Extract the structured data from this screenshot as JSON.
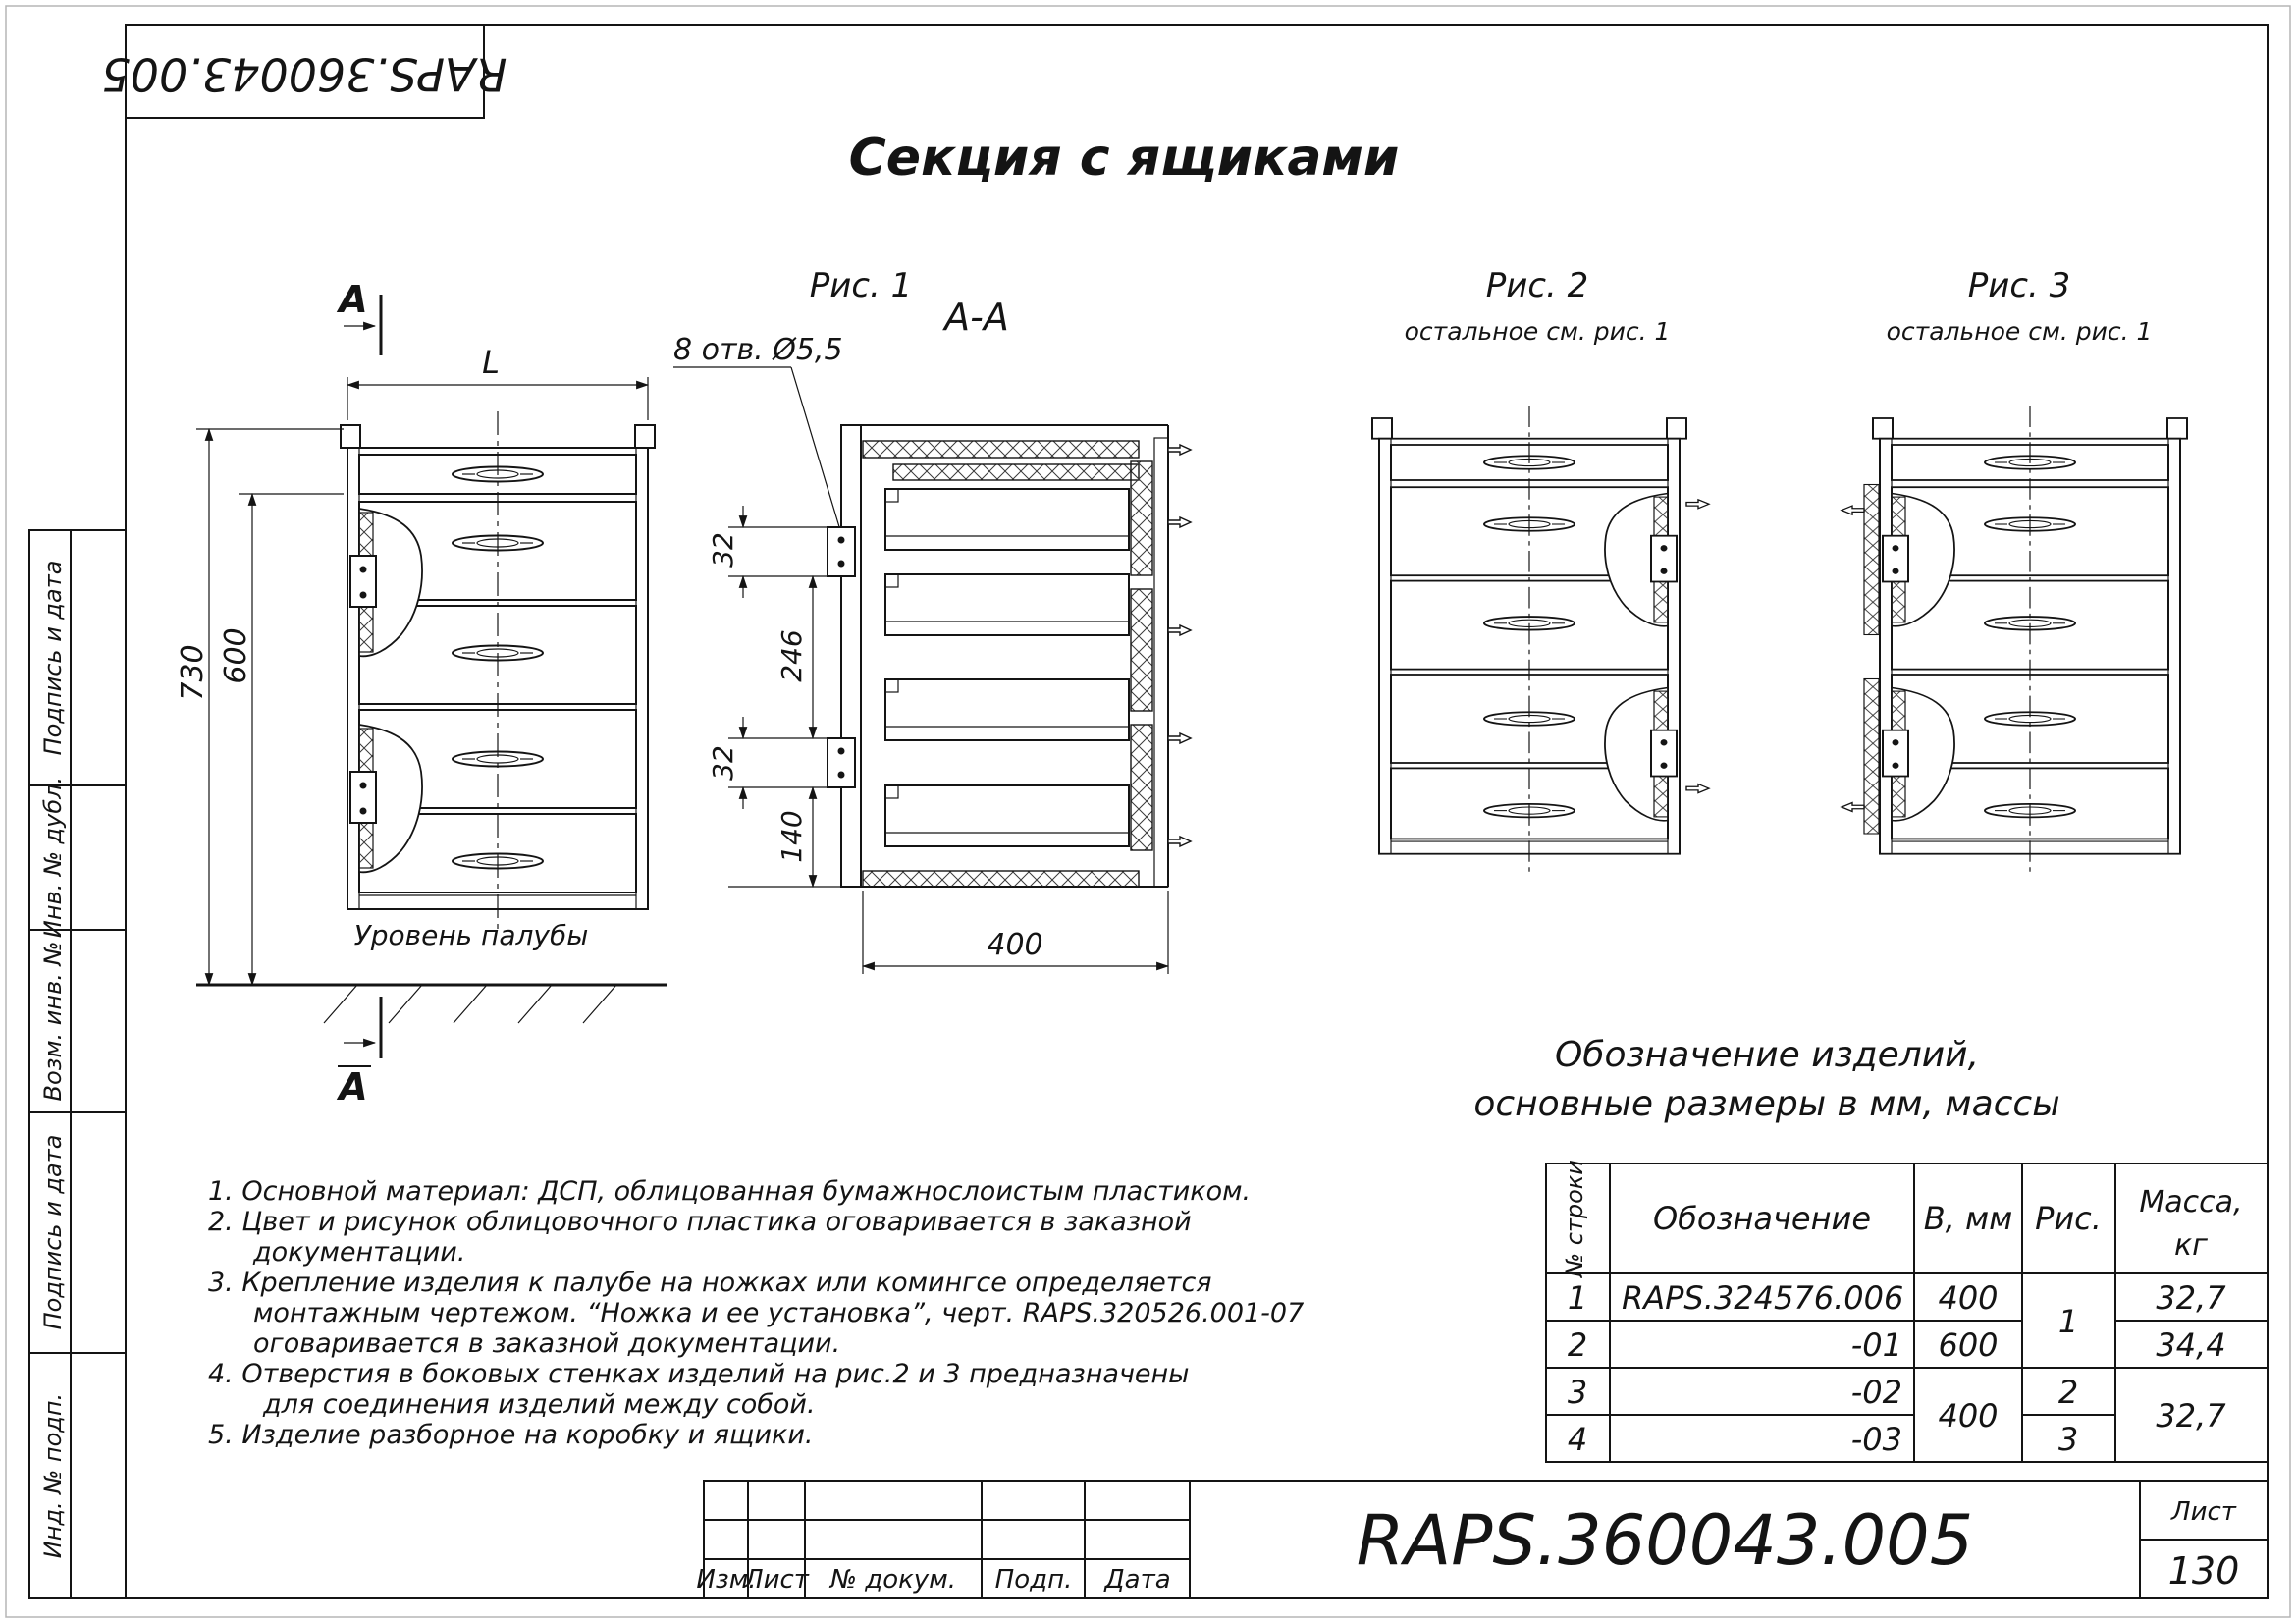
{
  "colors": {
    "ink": "#141414",
    "paper": "#ffffff"
  },
  "sheet": {
    "title": "Секция с ящиками"
  },
  "stamp_top": {
    "doc_number": "RAPS.360043.005"
  },
  "sidebar": {
    "labels": [
      "Подпись и дата",
      "Инв. № дубл.",
      "Возм. инв. №",
      "Подпись и дата",
      "Инд. № подп."
    ]
  },
  "figures": {
    "fig1": {
      "caption": "Рис. 1",
      "section_label": "A-A",
      "holes_note": "8 отв. Ø5,5",
      "deck_label": "Уровень палубы",
      "cut_letter": "A",
      "dims": {
        "L": "L",
        "h_full": "730",
        "h_600": "600",
        "top_offset": "32",
        "spacing": "246",
        "offset2": "32",
        "bottom": "140",
        "depth": "400"
      }
    },
    "fig2": {
      "caption": "Рис. 2",
      "note": "остальное см. рис. 1"
    },
    "fig3": {
      "caption": "Рис. 3",
      "note": "остальное см. рис. 1"
    }
  },
  "notes": [
    "1. Основной материал: ДСП, облицованная бумажнослоистым пластиком.",
    "2. Цвет и рисунок облицовочного пластика оговаривается в заказной",
    "документации.",
    "3. Крепление изделия к палубе на ножках или комингсе определяется",
    "монтажным чертежом. “Ножка и ее установка”, черт.  RAPS.320526.001-07",
    "оговаривается в заказной документации.",
    "4. Отверстия в боковых стенках изделий на рис.2 и 3 предназначены",
    "для соединения изделий между собой.",
    "5. Изделие разборное на коробку и ящики."
  ],
  "parts_table": {
    "heading_line1": "Обозначение изделий,",
    "heading_line2": "основные размеры в мм, массы",
    "headers": {
      "row": "№ строки",
      "designation": "Обозначение",
      "b": "В, мм",
      "fig": "Рис.",
      "mass_line1": "Масса,",
      "mass_line2": "кг"
    },
    "rows": [
      {
        "n": "1",
        "designation": "RAPS.324576.006",
        "b": "400",
        "mass": "32,7"
      },
      {
        "n": "2",
        "designation": "-01",
        "b": "600",
        "mass": "34,4"
      },
      {
        "n": "3",
        "designation": "-02",
        "fig": "2"
      },
      {
        "n": "4",
        "designation": "-03",
        "fig": "3"
      }
    ],
    "merged": {
      "fig_rows12": "1",
      "b_rows34": "400",
      "mass_rows34": "32,7"
    }
  },
  "title_block": {
    "cols": [
      "Изм.",
      "Лист",
      "№ докум.",
      "Подп.",
      "Дата"
    ],
    "doc_number": "RAPS.360043.005",
    "sheet_label": "Лист",
    "sheet_number": "130"
  }
}
